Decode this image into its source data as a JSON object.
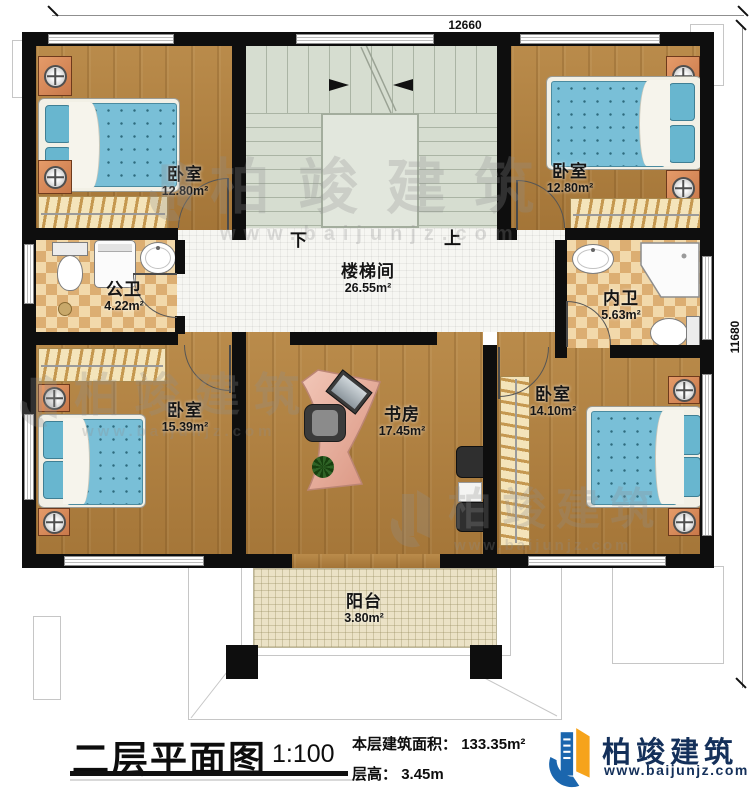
{
  "dimensions": {
    "width": "12660",
    "height": "11680"
  },
  "rooms": {
    "bedroom_tl": {
      "name": "卧室",
      "area": "12.80m²"
    },
    "bedroom_tr": {
      "name": "卧室",
      "area": "12.80m²"
    },
    "stairwell": {
      "name": "楼梯间",
      "area": "26.55m²"
    },
    "public_bath": {
      "name": "公卫",
      "area": "4.22m²"
    },
    "inner_bath": {
      "name": "内卫",
      "area": "5.63m²"
    },
    "bedroom_bl": {
      "name": "卧室",
      "area": "15.39m²"
    },
    "study": {
      "name": "书房",
      "area": "17.45m²"
    },
    "bedroom_br": {
      "name": "卧室",
      "area": "14.10m²"
    },
    "balcony": {
      "name": "阳台",
      "area": "3.80m²"
    }
  },
  "stairs": {
    "down_label": "下",
    "up_label": "上"
  },
  "title_block": {
    "title": "二层平面图",
    "scale": "1:100",
    "floor_area_label": "本层建筑面积：",
    "floor_area_value": "133.35m²",
    "floor_height_label": "层高：",
    "floor_height_value": "3.45m"
  },
  "brand": {
    "name": "柏竣建筑",
    "website": "www.baijunjz.com"
  },
  "colors": {
    "wall": "#0e0e0e",
    "wood_floor": "#b2813f",
    "bath_tile": "#dcae72",
    "stair_floor": "#d6ddd0",
    "mattress": "#79bfd7",
    "brand_blue": "#1b66ae",
    "brand_orange": "#f6a31b",
    "brand_navy": "#14305a"
  }
}
